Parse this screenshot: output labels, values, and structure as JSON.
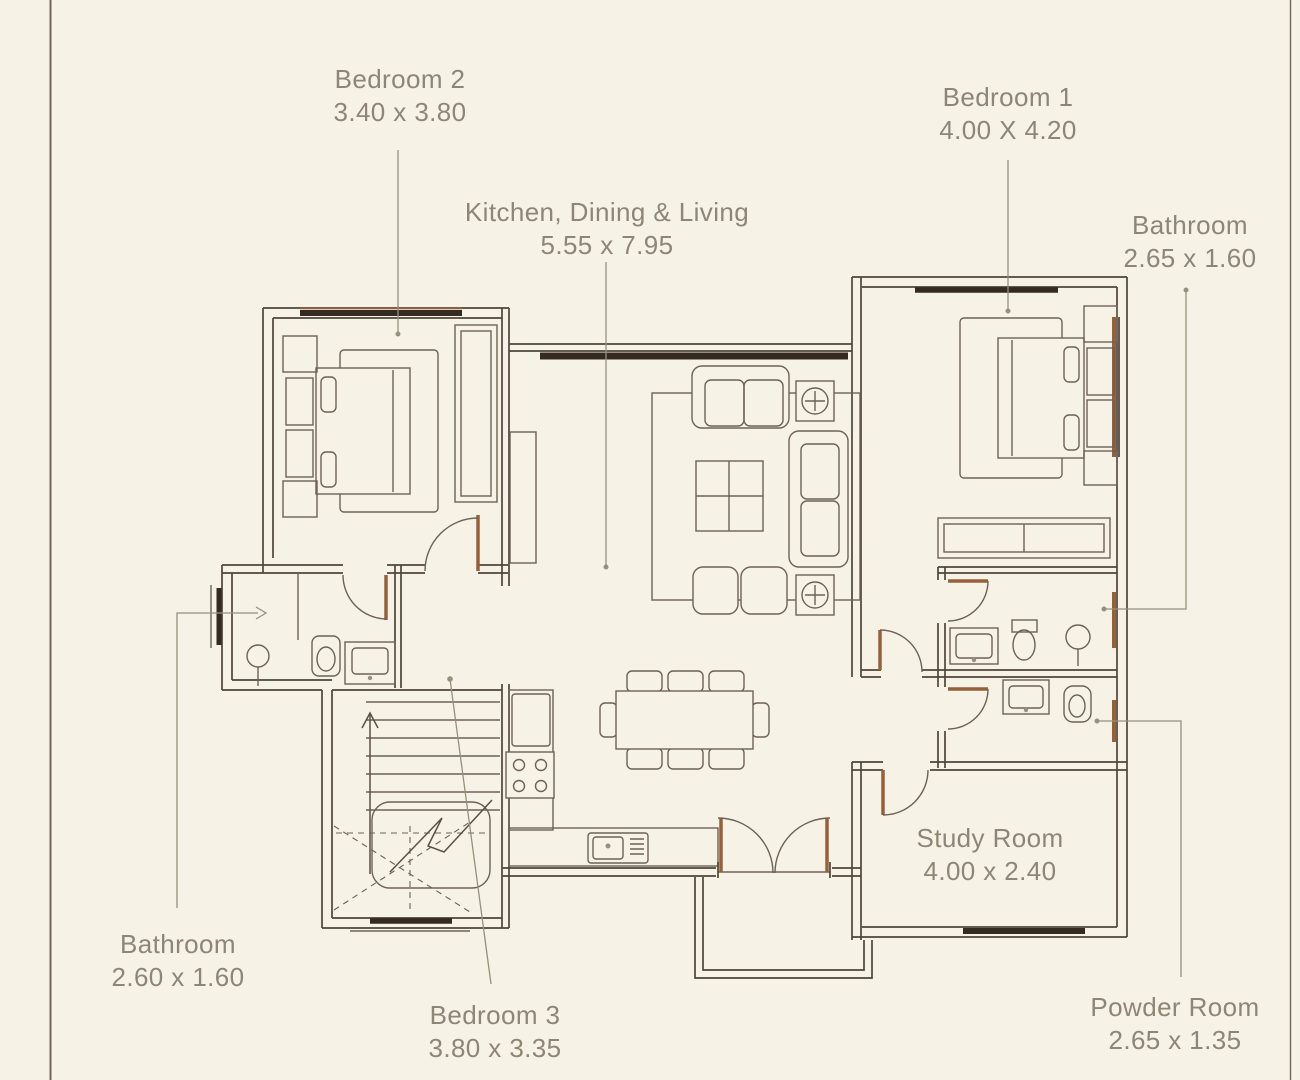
{
  "colors": {
    "paper": "#f7f2e6",
    "wall": "#4e443b",
    "furn": "#6d6154",
    "winDark": "#342a20",
    "rust": "#95613d",
    "leader": "#96907f",
    "text": "#8d8677",
    "frame": "#6f6559"
  },
  "labels": {
    "bedroom2": {
      "name": "Bedroom 2",
      "dims": "3.40 x 3.80"
    },
    "kitchenDiningLiving": {
      "name": "Kitchen, Dining & Living",
      "dims": "5.55 x 7.95"
    },
    "bedroom1": {
      "name": "Bedroom 1",
      "dims": "4.00 X 4.20"
    },
    "bathroomRight": {
      "name": "Bathroom",
      "dims": "2.65 x 1.60"
    },
    "bathroomLeft": {
      "name": "Bathroom",
      "dims": "2.60 x 1.60"
    },
    "bedroom3": {
      "name": "Bedroom 3",
      "dims": "3.80 x 3.35"
    },
    "studyRoom": {
      "name": "Study Room",
      "dims": "4.00 x 2.40"
    },
    "powderRoom": {
      "name": "Powder Room",
      "dims": "2.65 x 1.35"
    }
  }
}
